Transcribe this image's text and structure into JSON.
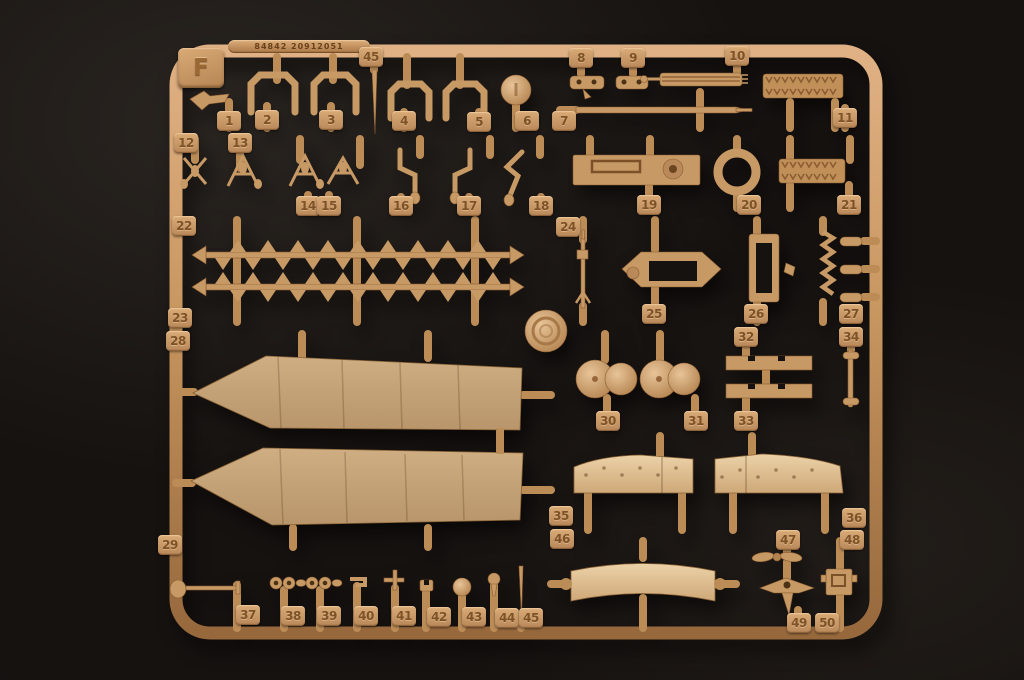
{
  "sprue": {
    "letter": "F",
    "mold_code": "84842 20912051"
  },
  "colors": {
    "background": "#161210",
    "runner": "#c4935f",
    "runner_light": "#e3b487",
    "runner_dark": "#8f6136",
    "panel": "#c3a076",
    "panel_light": "#e4c69c",
    "tab_bg": "#cfa06c",
    "tab_text": "#7e5227"
  },
  "parts": [
    {
      "n": "1",
      "x": 229,
      "y": 121
    },
    {
      "n": "2",
      "x": 267,
      "y": 120
    },
    {
      "n": "3",
      "x": 331,
      "y": 120
    },
    {
      "n": "4",
      "x": 404,
      "y": 121
    },
    {
      "n": "5",
      "x": 479,
      "y": 122
    },
    {
      "n": "6",
      "x": 527,
      "y": 121
    },
    {
      "n": "7",
      "x": 564,
      "y": 121
    },
    {
      "n": "8",
      "x": 581,
      "y": 58
    },
    {
      "n": "9",
      "x": 633,
      "y": 58
    },
    {
      "n": "10",
      "x": 737,
      "y": 56
    },
    {
      "n": "11",
      "x": 845,
      "y": 118
    },
    {
      "n": "12",
      "x": 186,
      "y": 143
    },
    {
      "n": "13",
      "x": 240,
      "y": 143
    },
    {
      "n": "14",
      "x": 308,
      "y": 206
    },
    {
      "n": "15",
      "x": 329,
      "y": 206
    },
    {
      "n": "16",
      "x": 401,
      "y": 206
    },
    {
      "n": "17",
      "x": 469,
      "y": 206
    },
    {
      "n": "18",
      "x": 541,
      "y": 206
    },
    {
      "n": "19",
      "x": 649,
      "y": 205
    },
    {
      "n": "20",
      "x": 749,
      "y": 205
    },
    {
      "n": "21",
      "x": 849,
      "y": 205
    },
    {
      "n": "22",
      "x": 184,
      "y": 226
    },
    {
      "n": "23",
      "x": 180,
      "y": 318
    },
    {
      "n": "24",
      "x": 568,
      "y": 227
    },
    {
      "n": "25",
      "x": 654,
      "y": 314
    },
    {
      "n": "26",
      "x": 756,
      "y": 314
    },
    {
      "n": "27",
      "x": 851,
      "y": 314
    },
    {
      "n": "28",
      "x": 178,
      "y": 341
    },
    {
      "n": "29",
      "x": 170,
      "y": 545
    },
    {
      "n": "30",
      "x": 608,
      "y": 421
    },
    {
      "n": "31",
      "x": 696,
      "y": 421
    },
    {
      "n": "32",
      "x": 746,
      "y": 337
    },
    {
      "n": "33",
      "x": 746,
      "y": 421
    },
    {
      "n": "34",
      "x": 851,
      "y": 337
    },
    {
      "n": "35",
      "x": 561,
      "y": 516
    },
    {
      "n": "36",
      "x": 854,
      "y": 518
    },
    {
      "n": "37",
      "x": 248,
      "y": 615
    },
    {
      "n": "38",
      "x": 293,
      "y": 616
    },
    {
      "n": "39",
      "x": 329,
      "y": 616
    },
    {
      "n": "40",
      "x": 366,
      "y": 616
    },
    {
      "n": "41",
      "x": 404,
      "y": 616
    },
    {
      "n": "42",
      "x": 439,
      "y": 617
    },
    {
      "n": "43",
      "x": 474,
      "y": 617
    },
    {
      "n": "44",
      "x": 507,
      "y": 618
    },
    {
      "n": "45",
      "x": 531,
      "y": 618
    },
    {
      "n": "45",
      "x": 371,
      "y": 57
    },
    {
      "n": "46",
      "x": 562,
      "y": 539
    },
    {
      "n": "47",
      "x": 788,
      "y": 540
    },
    {
      "n": "48",
      "x": 852,
      "y": 540
    },
    {
      "n": "49",
      "x": 799,
      "y": 623
    },
    {
      "n": "50",
      "x": 827,
      "y": 623
    }
  ]
}
